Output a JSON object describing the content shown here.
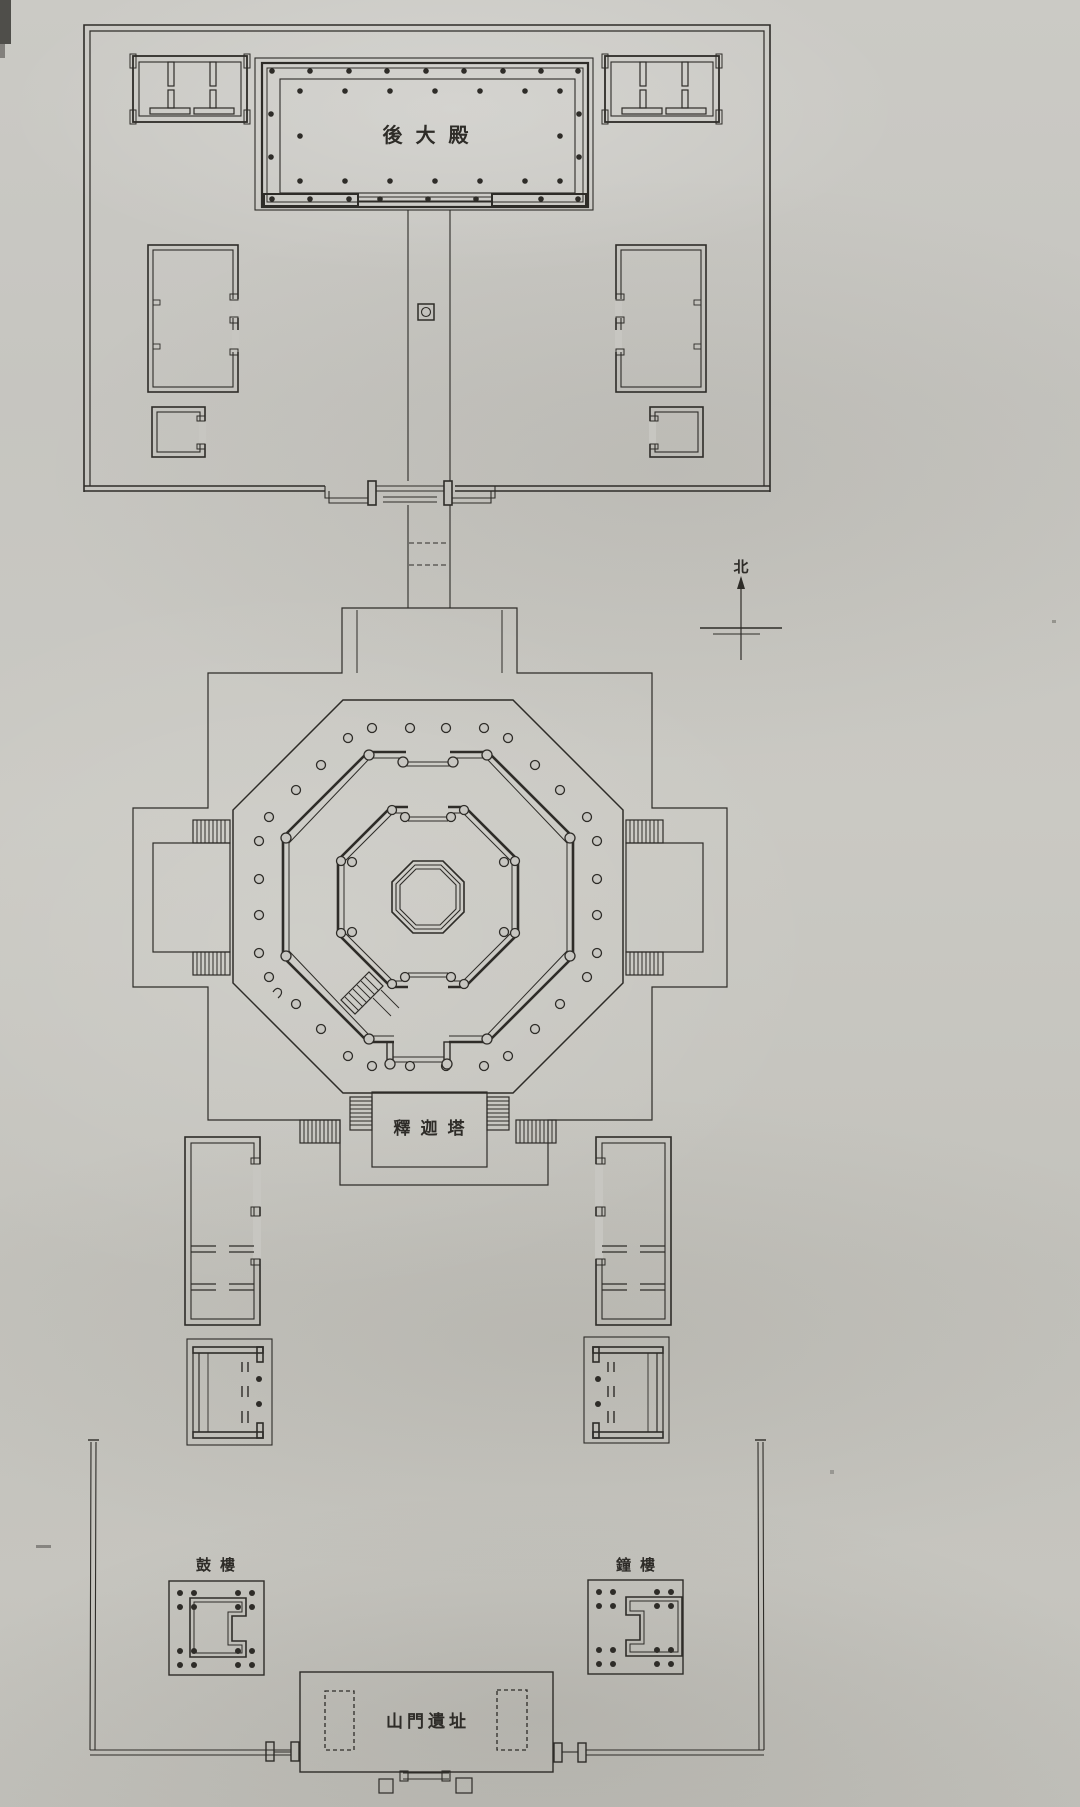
{
  "colors": {
    "paper": "#c7c6c1",
    "ink": "#2e2c28"
  },
  "plan": {
    "rear_hall_label": "後大殿",
    "pagoda_label": "釋迦塔",
    "drum_tower_label": "鼓樓",
    "bell_tower_label": "鐘樓",
    "gate_label": "山門遺址",
    "north_label": "北"
  }
}
